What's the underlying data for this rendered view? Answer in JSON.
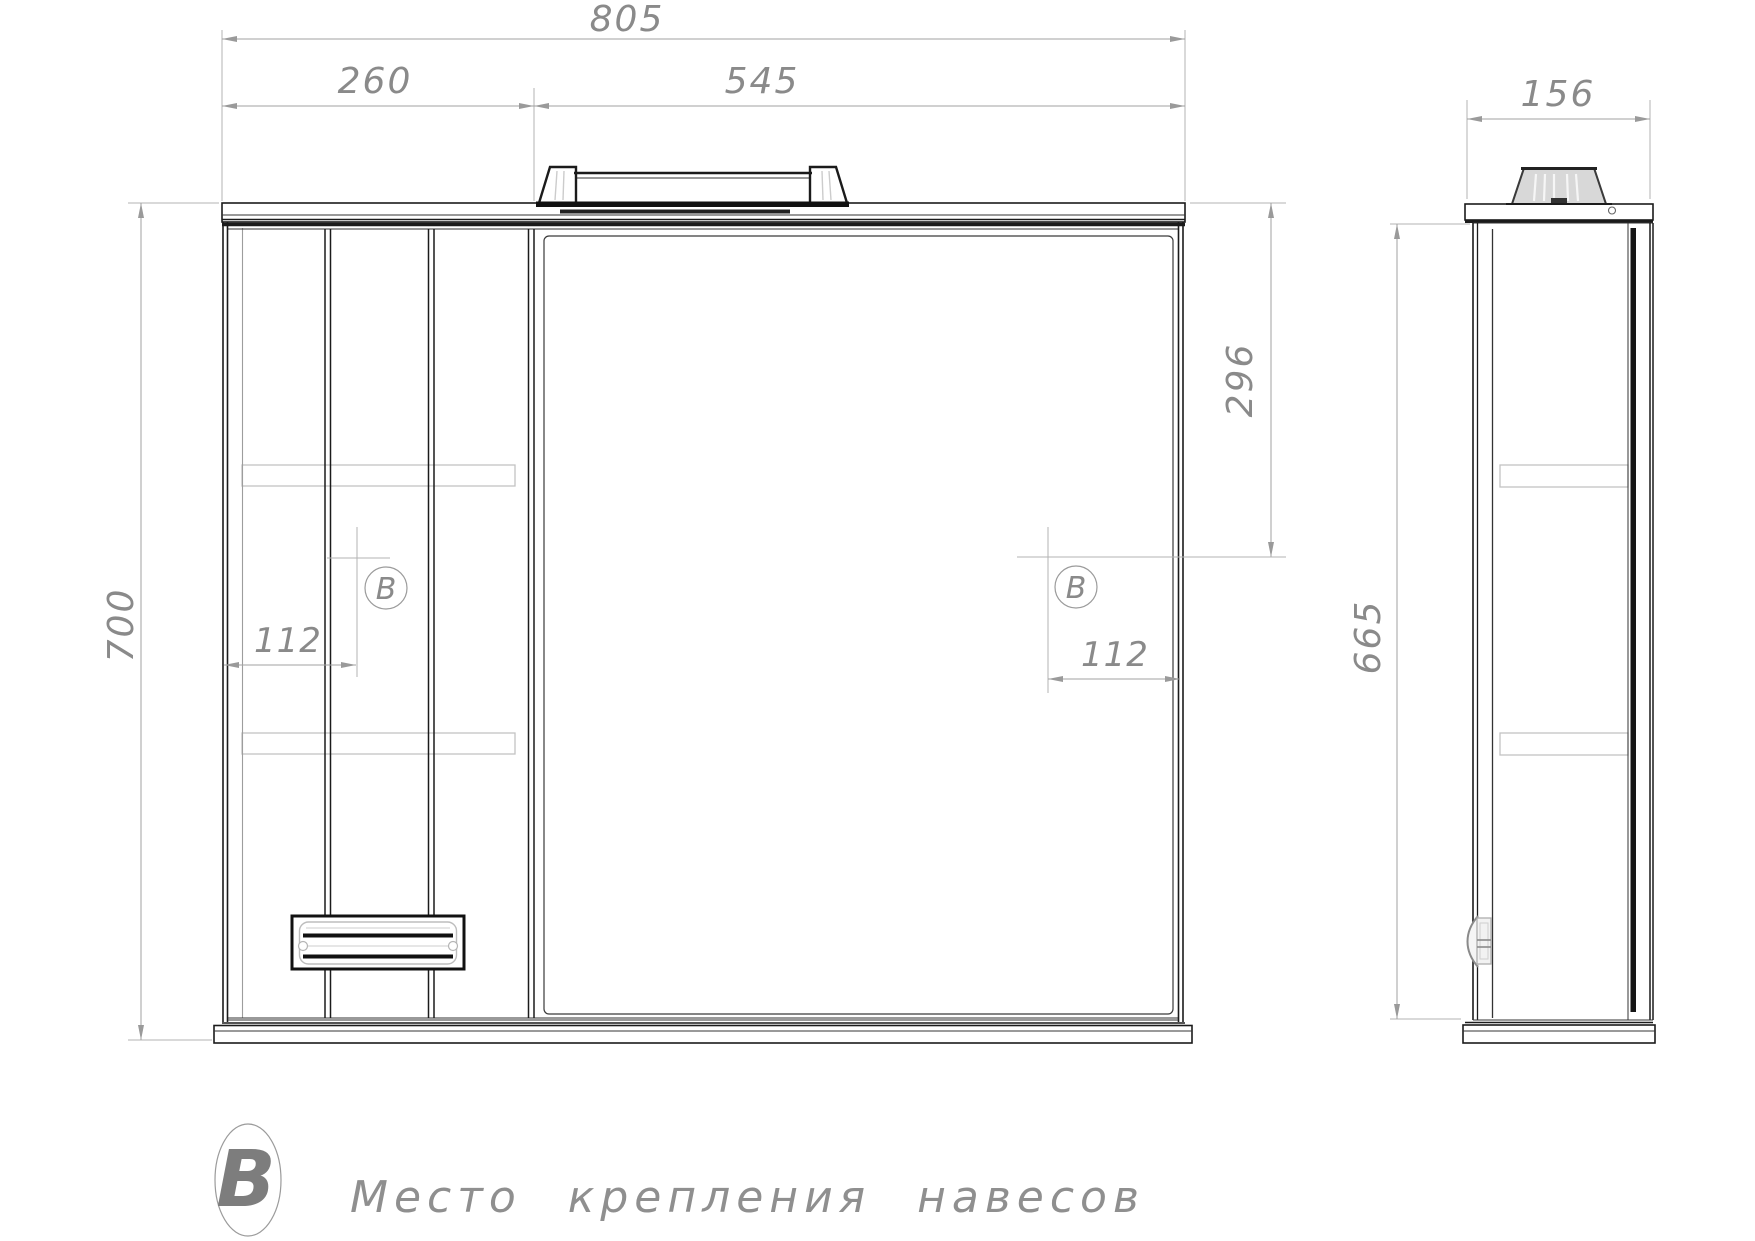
{
  "palette": {
    "line": "#1b1b1b",
    "dim_line": "#a2a2a2",
    "dim_text": "#8a8a8a",
    "shelf_outline": "#c3c3c3",
    "lamp_fill": "#d8d8d8",
    "background": "#ffffff"
  },
  "front_view": {
    "width_total": "805",
    "width_left_cabinet": "260",
    "width_mirror": "545",
    "height_total": "700",
    "hinge_offset_top": "296",
    "hinge_offset_left": "112",
    "hinge_offset_right": "112",
    "hinge_marker_left": "В",
    "hinge_marker_right": "В"
  },
  "side_view": {
    "depth": "156",
    "height_body": "665"
  },
  "legend": {
    "marker": "В",
    "label": "Место крепления навесов"
  }
}
